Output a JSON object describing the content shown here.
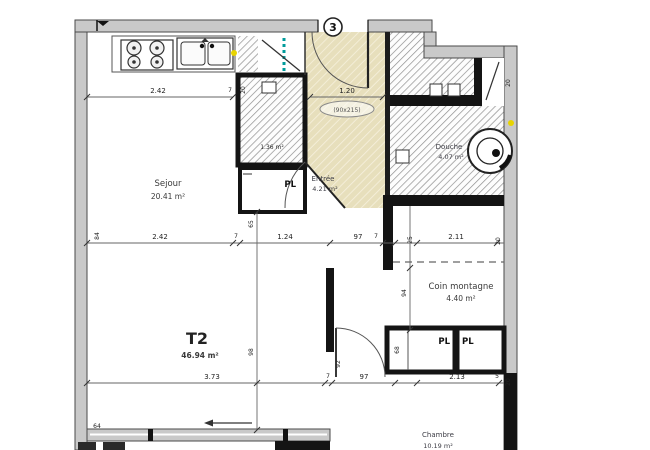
{
  "floorplan": {
    "lot_badge": "3",
    "unit": {
      "label": "T2",
      "area": "46.94 m²"
    },
    "rooms": [
      {
        "id": "sejour",
        "name": "Sejour",
        "area": "20.41 m²"
      },
      {
        "id": "entree",
        "name": "Entrée",
        "area": "4.21 m²"
      },
      {
        "id": "douche",
        "name": "Douche",
        "area": "4.07 m²"
      },
      {
        "id": "coin-montagne",
        "name": "Coin montagne",
        "area": "4.40 m²"
      },
      {
        "id": "chambre",
        "name": "Chambre",
        "area": "10.19 m²"
      },
      {
        "id": "gaine",
        "name": "",
        "area": "1.36 m²"
      }
    ],
    "closets": {
      "pl1": "PL",
      "pl2": "PL",
      "pl3": "PL"
    },
    "door_annotation": {
      "width": "1.20",
      "size": "(90x215)"
    },
    "dims": {
      "top": [
        "2.42",
        "7",
        "20"
      ],
      "mid": [
        "2.42",
        "7",
        "1.24",
        "97",
        "7",
        "25",
        "2.11",
        "20"
      ],
      "bottom": [
        "3.73",
        "7",
        "97",
        "2.13",
        "5",
        "20"
      ],
      "vertical": [
        "84",
        "65",
        "98",
        "94",
        "68",
        "92",
        "20",
        "64"
      ]
    },
    "icons": {
      "stove": "stove-icon",
      "sink": "double-sink-icon",
      "shower": "shower-icon",
      "flag": "north-flag-icon"
    }
  }
}
